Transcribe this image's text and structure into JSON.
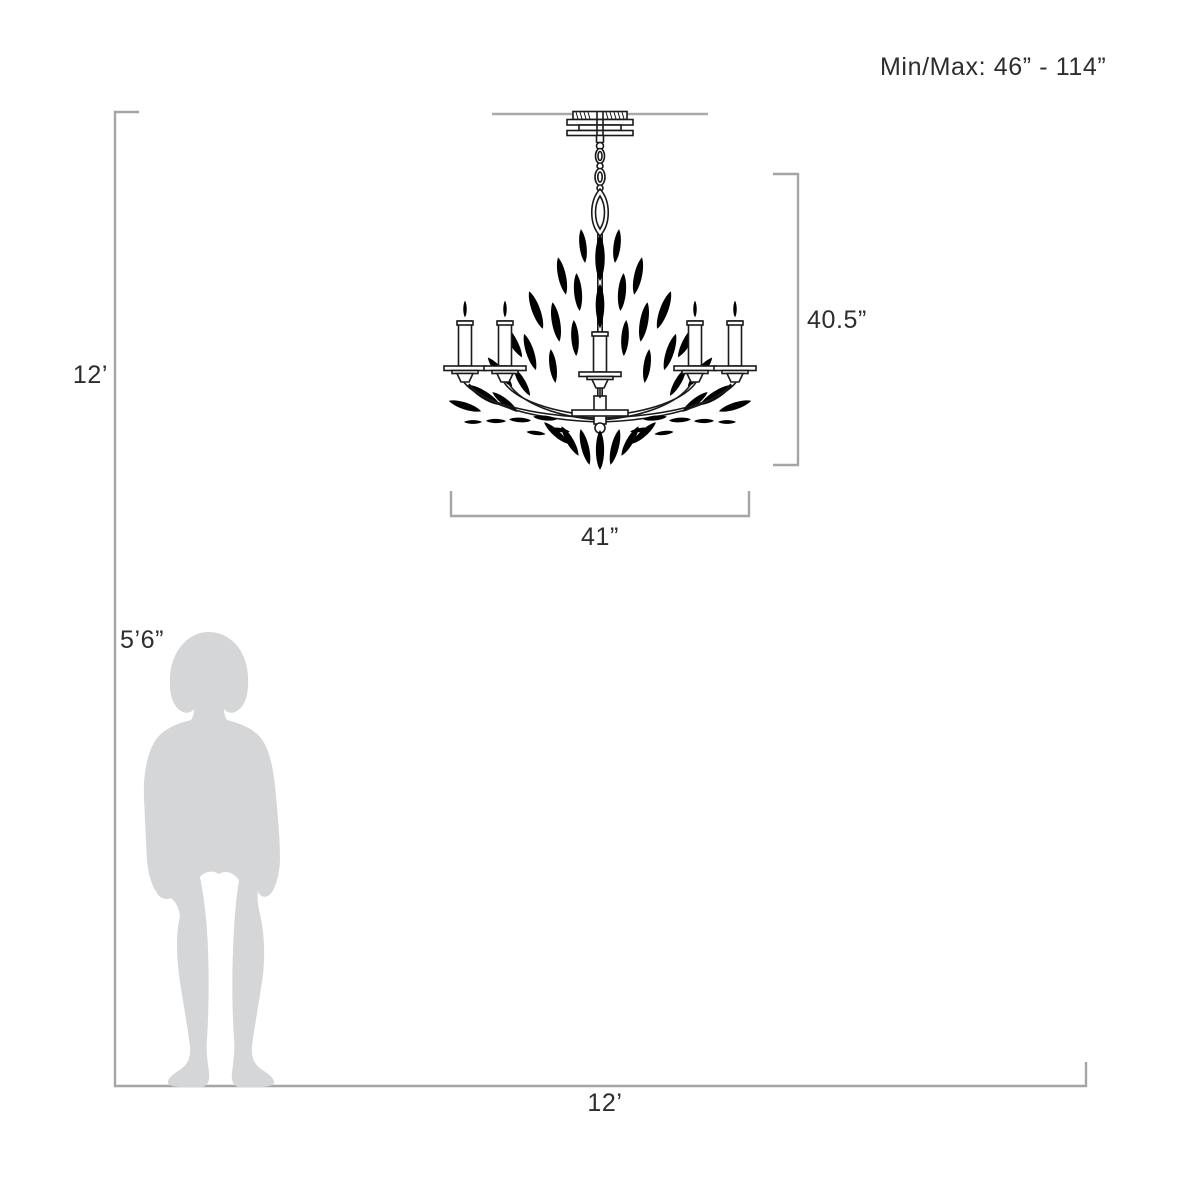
{
  "diagram": {
    "annotation": {
      "min_max": "Min/Max: 46” - 114”"
    },
    "fixture": {
      "height": "40.5”",
      "width": "41”"
    },
    "room": {
      "height": "12’",
      "width": "12’"
    },
    "person": {
      "height": "5’6”"
    },
    "colors": {
      "background": "#ffffff",
      "dimension_line": "#a5a5a5",
      "drawing_line": "#1a1a1a",
      "silhouette": "#d4d6d8",
      "text": "#2d2d2d"
    }
  }
}
